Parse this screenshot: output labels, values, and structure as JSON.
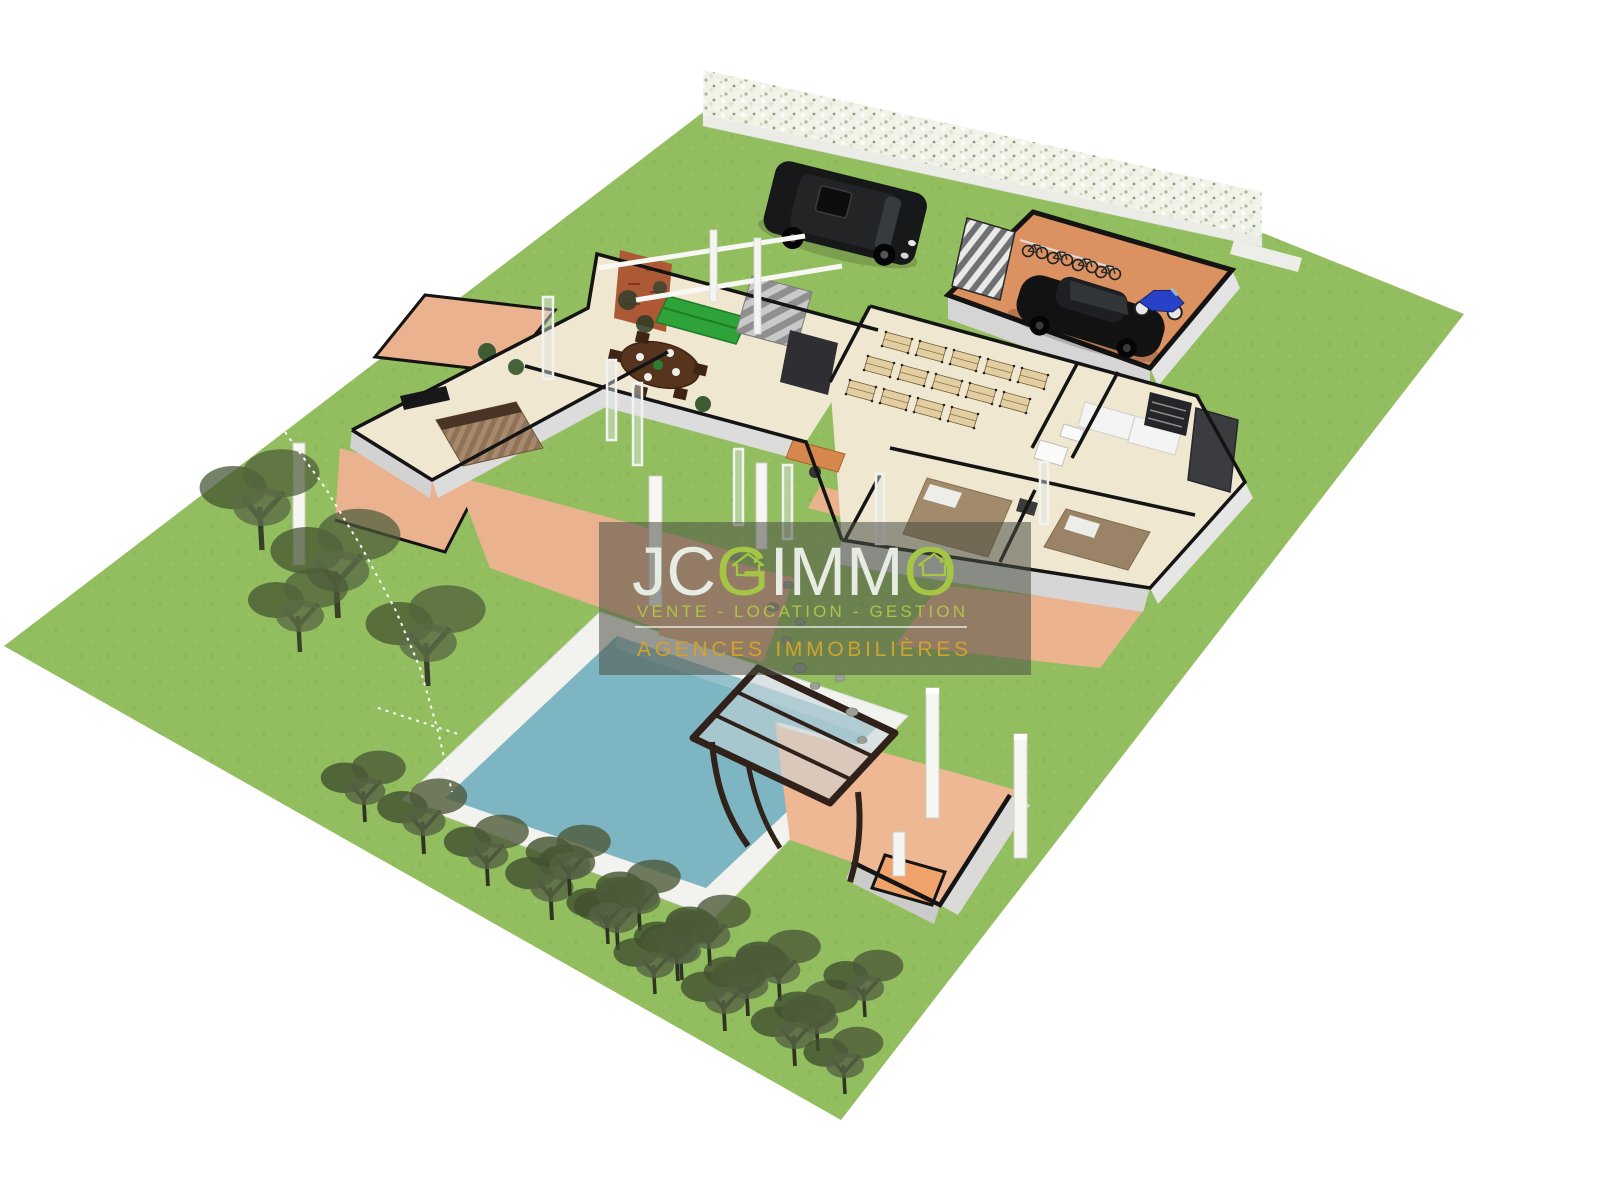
{
  "watermark": {
    "brand": {
      "jc": "JC",
      "g": "G",
      "imm": "IMM",
      "o": "O"
    },
    "tagline": "VENTE - LOCATION - GESTION",
    "subtitle": "AGENCES IMMOBILIÈRES"
  },
  "palette": {
    "grass": "#93BE5F",
    "pool_water": "#7EB5C2",
    "pool_deck": "#F2F2EF",
    "terrace": "#EAB28E",
    "floor_cream": "#F0E7D1",
    "wall_black": "#141414",
    "wall_face": "#D9D9D6",
    "garage_floor": "#DC9160",
    "pergola_frame": "#30221A",
    "sofa_green": "#2EA339",
    "brick": "#AE5936",
    "tree_olive": "#4C5A38",
    "hedge_white": "#EFF2E6",
    "rock_gray": "#9AA096",
    "overlay_dark": "#4A4E44",
    "logo_light": "#E6ECE1",
    "logo_green": "#A5C544",
    "logo_tagline": "#AFC348",
    "logo_gold": "#D2A32B"
  }
}
